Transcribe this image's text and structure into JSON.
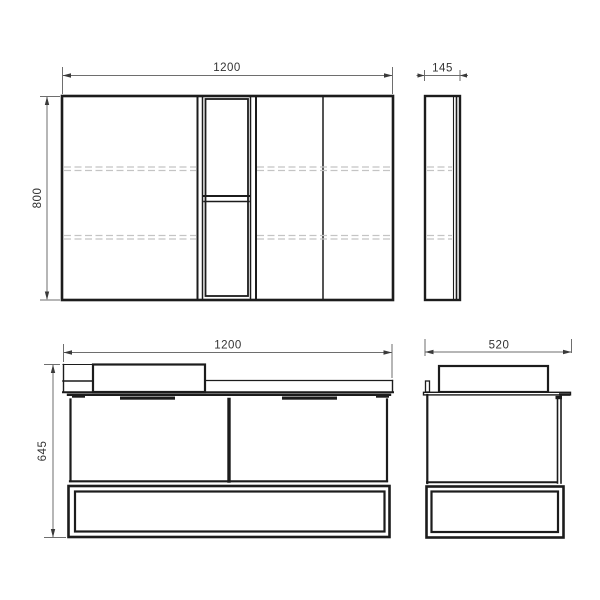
{
  "drawing": {
    "kind": "furniture-technical-drawing",
    "colors": {
      "background": "#ffffff",
      "object_line": "#1c1c1c",
      "dimension_line": "#6e6e6e",
      "hidden_line": "#c4c4c4",
      "label_text": "#333333"
    },
    "mirror_front": {
      "width": "1200",
      "height": "800"
    },
    "mirror_side": {
      "depth": "145"
    },
    "vanity_front": {
      "width": "1200",
      "height": "645"
    },
    "vanity_side": {
      "depth": "520"
    }
  }
}
